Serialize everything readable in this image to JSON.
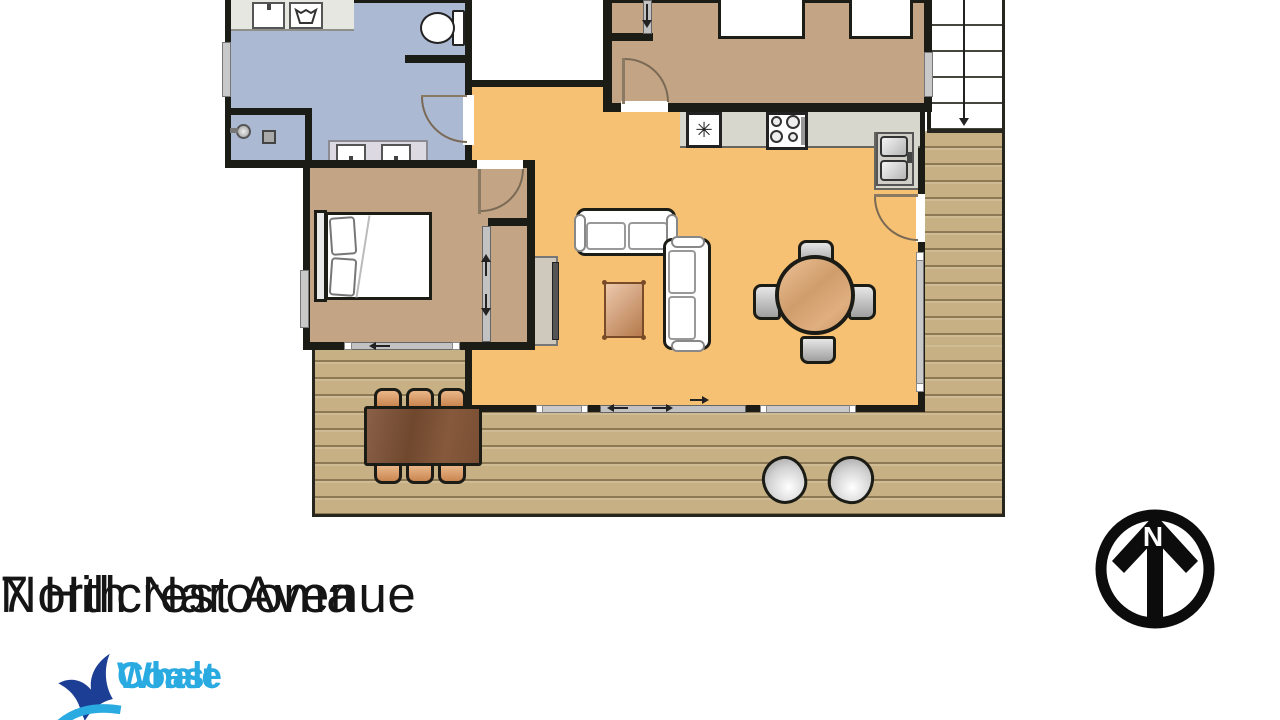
{
  "address": {
    "line1": "7 Hillcrest Avenue",
    "line2": "North Narooma"
  },
  "logo": {
    "word1": "Whale",
    "word2": "Coast"
  },
  "compass": {
    "label": "N"
  },
  "kitchen": {
    "fridge_symbol": "✳"
  },
  "colors": {
    "wall": "#1c1c16",
    "bathroom": "#abb9d3",
    "bedroom": "#c3a585",
    "living": "#f6c172",
    "deck": "#c7b083",
    "deck_line": "#a08a61",
    "counter": "#d7d7cd",
    "logo_blue": "#29aae1",
    "logo_navy": "#1c3e94",
    "text": "#151515"
  }
}
